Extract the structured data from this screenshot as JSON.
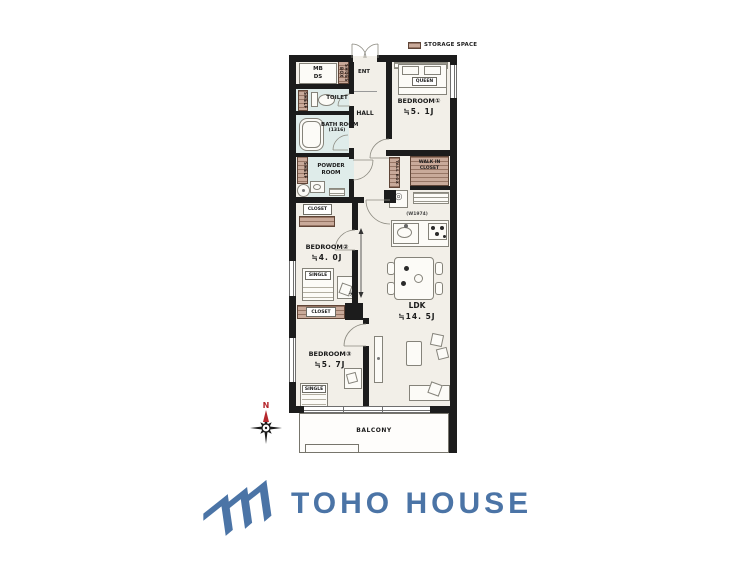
{
  "legend": {
    "storage_label": "STORAGE SPACE"
  },
  "plan": {
    "mb": "MB",
    "ds": "DS",
    "shoes_box": "SHOES BOX",
    "ent": "ENT",
    "toilet": "TOILET",
    "shelf_toilet": "SHELF",
    "shelf_powder": "SHELF",
    "bath_name": "BATH ROOM",
    "bath_size": "(1316)",
    "powder_line1": "POWDER",
    "powder_line2": "ROOM",
    "hall": "HALL",
    "bedroom1_name": "BEDROOM①",
    "bedroom1_size": "≒5. 1J",
    "queen": "QUEEN",
    "wic_line1": "WALK IN",
    "wic_line2": "CLOSET",
    "tall_box": "TALL BOX",
    "kitchen_width": "(W1974)",
    "ldk_name": "LDK",
    "ldk_size": "≒14. 5J",
    "bedroom2_name": "BEDROOM②",
    "bedroom2_size": "≒4. 0J",
    "single2": "SINGLE",
    "closet2": "CLOSET",
    "closet3": "CLOSET",
    "bedroom3_name": "BEDROOM③",
    "bedroom3_size": "≒5. 7J",
    "single3": "SINGLE",
    "balcony": "BALCONY",
    "plant_symbol": "✳",
    "appliance_symbol": "◎"
  },
  "compass": {
    "north": "N"
  },
  "logo": {
    "name": "TOHO HOUSE"
  },
  "colors": {
    "wall": "#1c1c1c",
    "floor": "#f2efe8",
    "wet_room": "#dfecea",
    "storage_tan": "#c9aa9a",
    "logo_blue": "#4b74a6",
    "compass_red": "#b5272c"
  }
}
